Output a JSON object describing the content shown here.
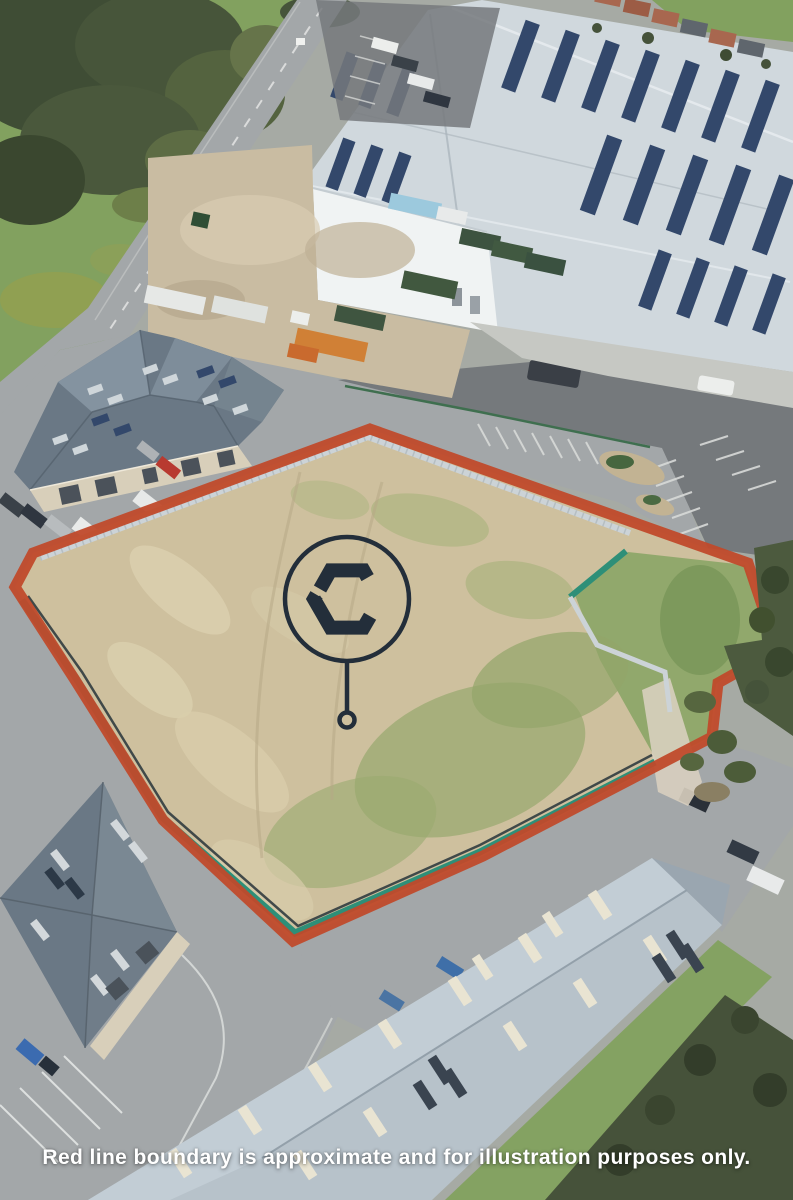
{
  "caption": {
    "text": "Red line boundary is approximate and for illustration purposes only."
  },
  "logo": {
    "letter": "C"
  },
  "colors": {
    "boundary_red": "#c04a2b",
    "fence_teal": "#2e8f78",
    "hoarding_gray": "#ccd3d7",
    "logo_navy": "#232e3a",
    "caption_white": "#ffffff",
    "plot_dirt": "#cec09e",
    "grass_green": "#82a15f",
    "road_gray": "#a3a7a9",
    "asphalt_dark": "#75797c",
    "roof_light": "#d0d8dd",
    "roof_slate": "#6a7885",
    "roof_blue_gray": "#b7c2ca",
    "solar_navy": "#33486b",
    "wall_white": "#f0f3f3",
    "wall_beige": "#d8cfba"
  }
}
